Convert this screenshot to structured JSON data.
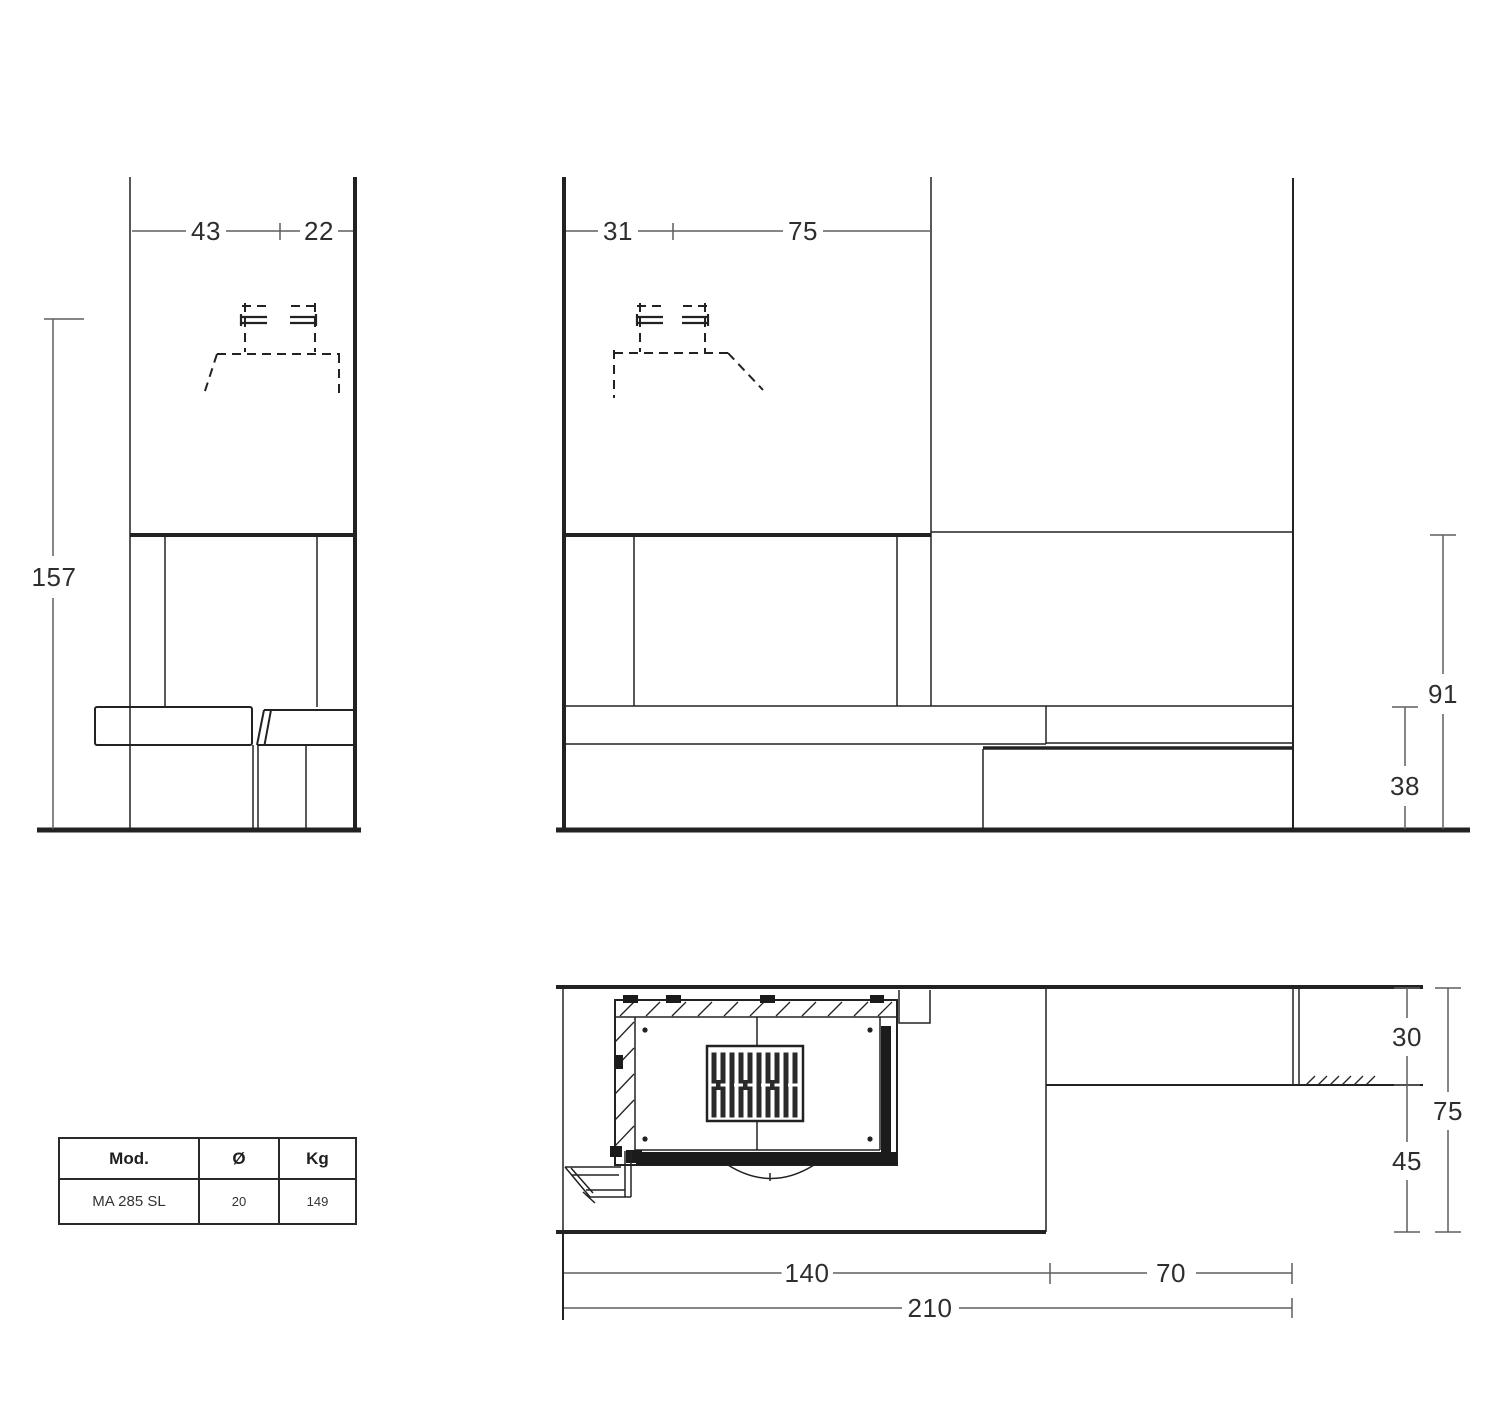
{
  "drawing": {
    "side_view": {
      "dim_width_inner": "43",
      "dim_width_outer": "22",
      "dim_height_total": "157"
    },
    "front_view": {
      "dim_width_left": "31",
      "dim_width_right": "75",
      "dim_height_mantel": "91",
      "dim_height_hearth": "38"
    },
    "plan_view": {
      "dim_depth_shelf": "30",
      "dim_depth_front": "45",
      "dim_depth_total": "75",
      "dim_width_hearth": "140",
      "dim_width_shelf": "70",
      "dim_width_total": "210"
    }
  },
  "spec_table": {
    "headers": {
      "model": "Mod.",
      "diameter": "Ø",
      "weight": "Kg"
    },
    "row": {
      "model": "MA 285 SL",
      "diameter": "20",
      "weight": "149"
    }
  },
  "colors": {
    "background": "#ffffff",
    "structure_line": "#222222",
    "dimension_line": "#5e5e5e",
    "label_text": "#2e2e2e"
  }
}
